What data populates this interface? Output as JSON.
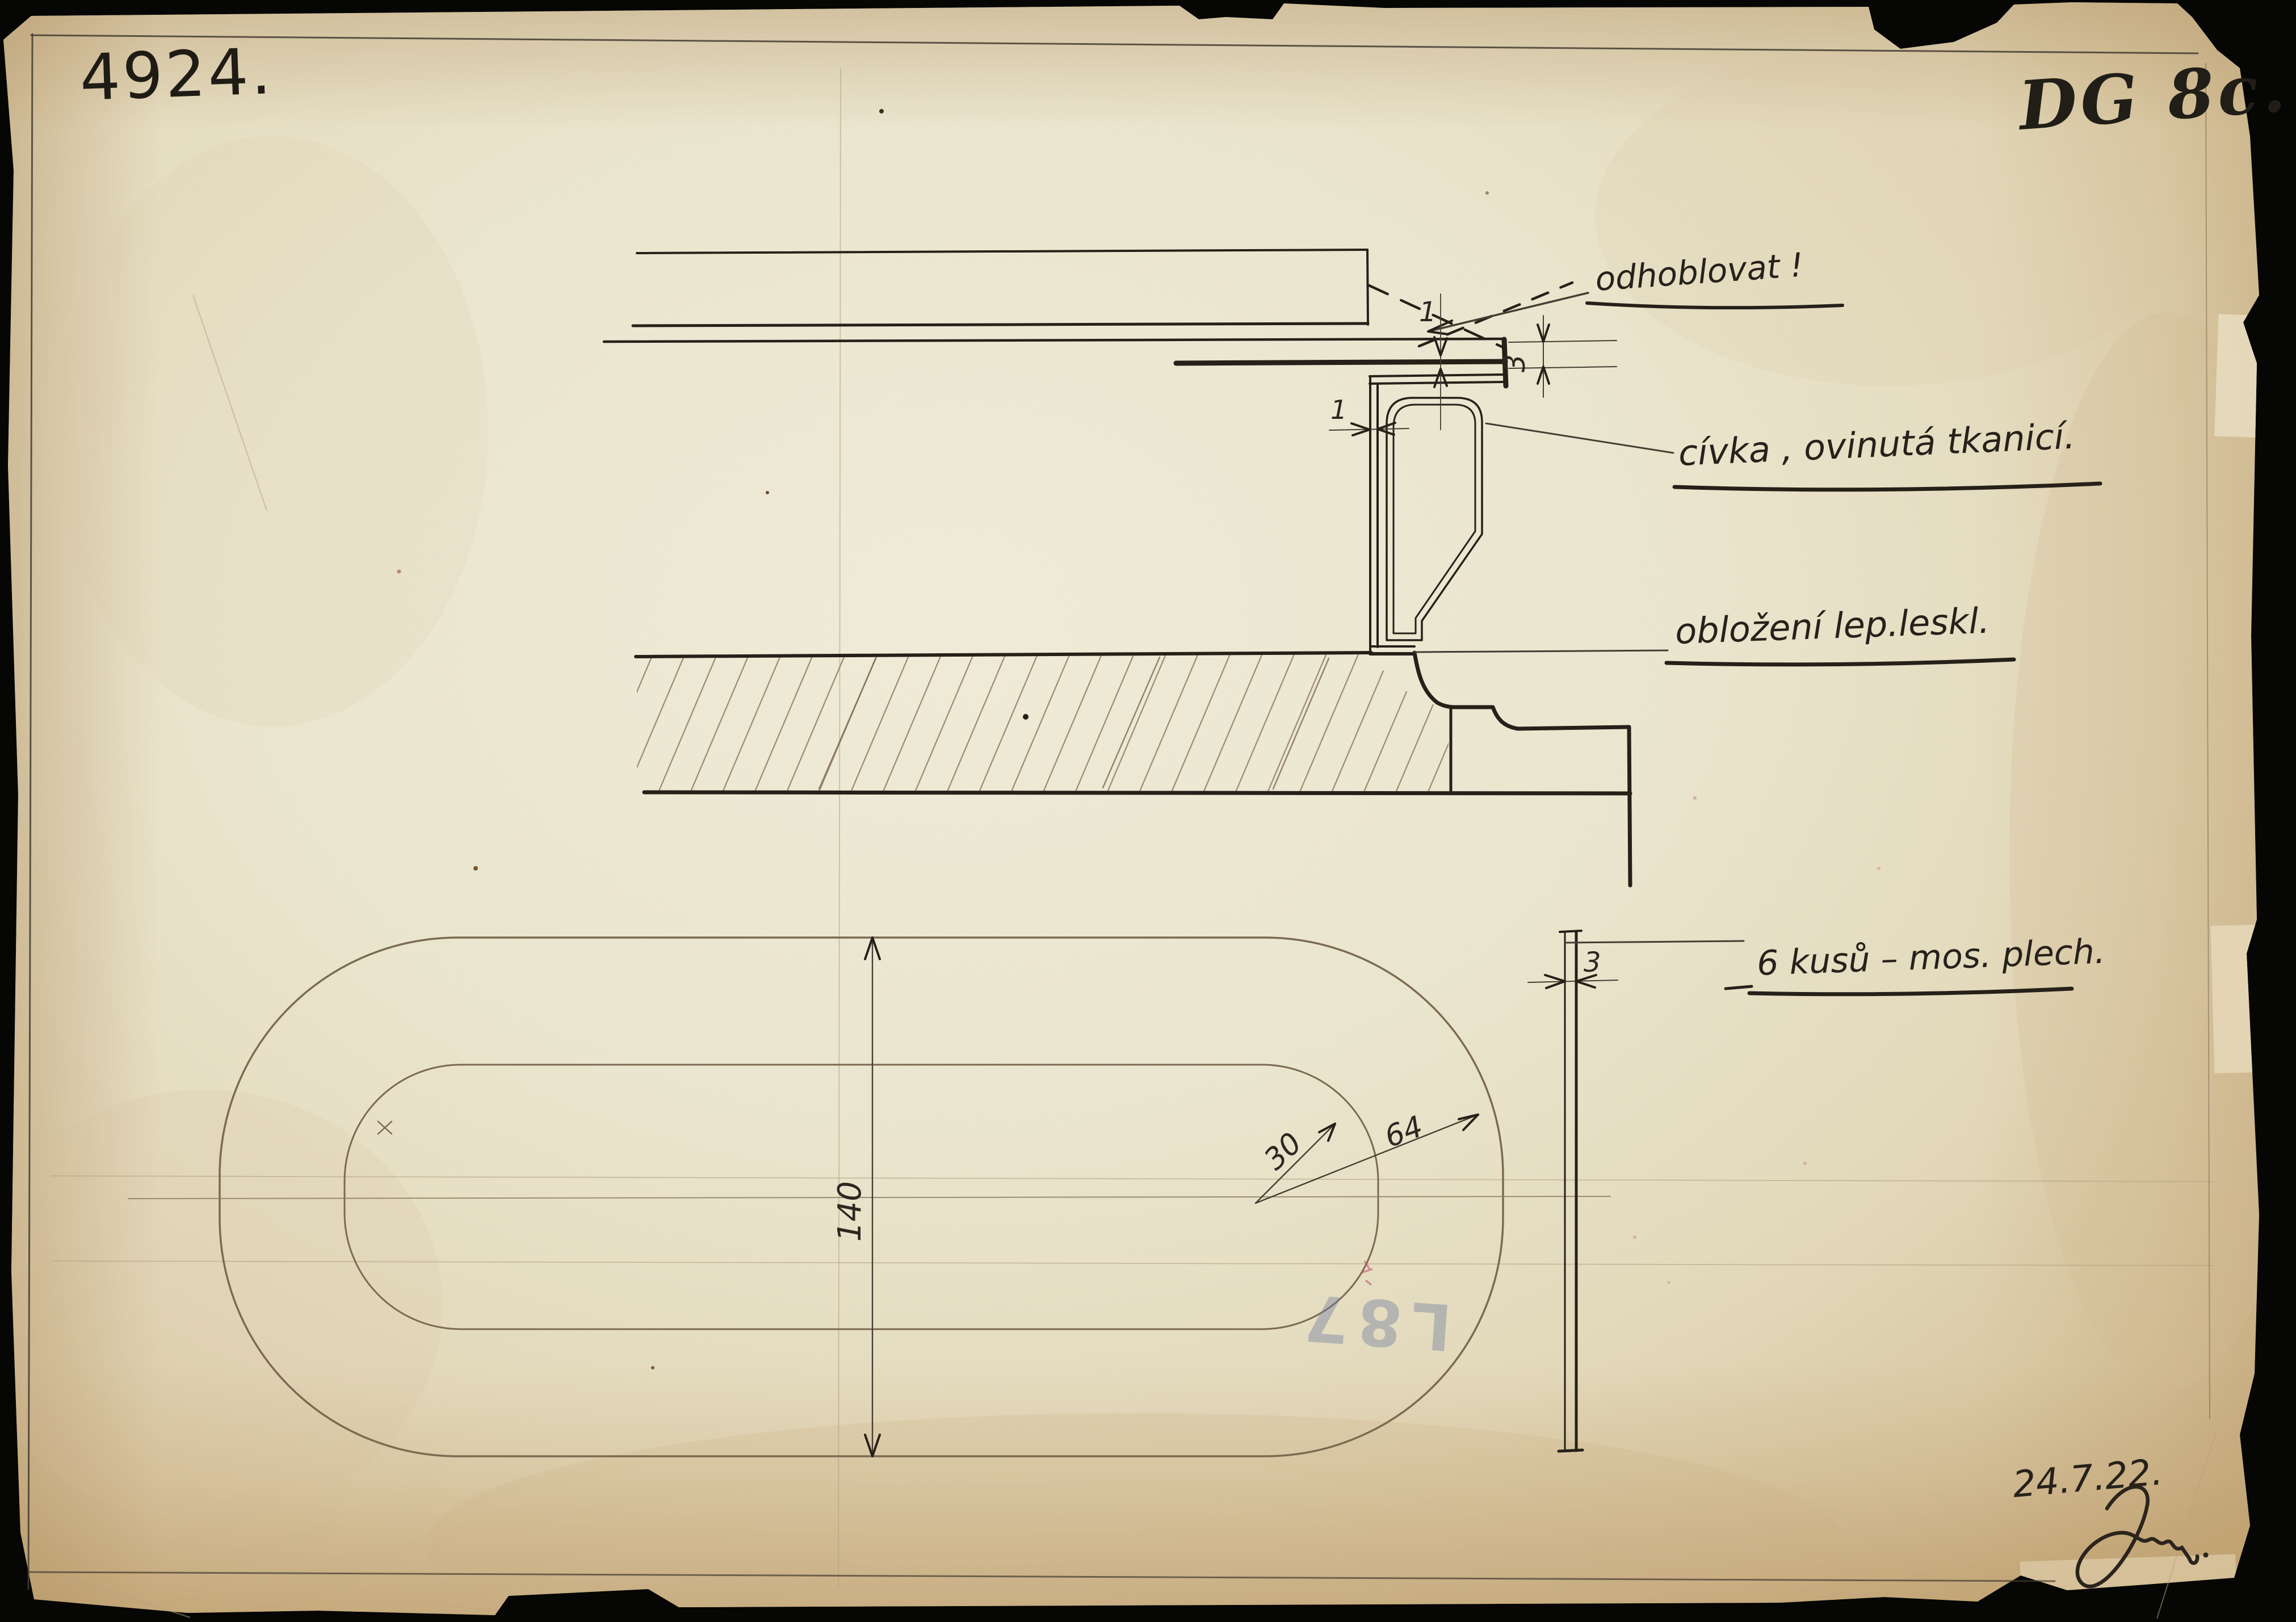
{
  "sheet": {
    "drawing_number": "4924.",
    "sheet_code": "DG 8c.",
    "date": "24.7.22.",
    "signature_scribble": "Šolm"
  },
  "annotations": {
    "plane_note": "odhoblovat !",
    "coil_label": "cívka , ovinutá tkanicí.",
    "lining_label": "obložení  lep.leskl.",
    "pieces_label": "6 kusů – mos. plech."
  },
  "dimensions": {
    "plate_stack_thickness": "3",
    "plate_sheet_thickness": "1",
    "channel_wall_thickness": "1",
    "side_sheet_thickness": "3",
    "oval_height": "140",
    "radius_inner": "30",
    "radius_outer": "64"
  },
  "stamp": {
    "text": "L87"
  },
  "colors": {
    "ink": "#262019",
    "pencil": "#7b6a50",
    "paper": "#ece7d0",
    "paper_edge": "#cdb58a",
    "stamp_blue": "#6d7b9e",
    "accent_red": "#c2556e"
  }
}
